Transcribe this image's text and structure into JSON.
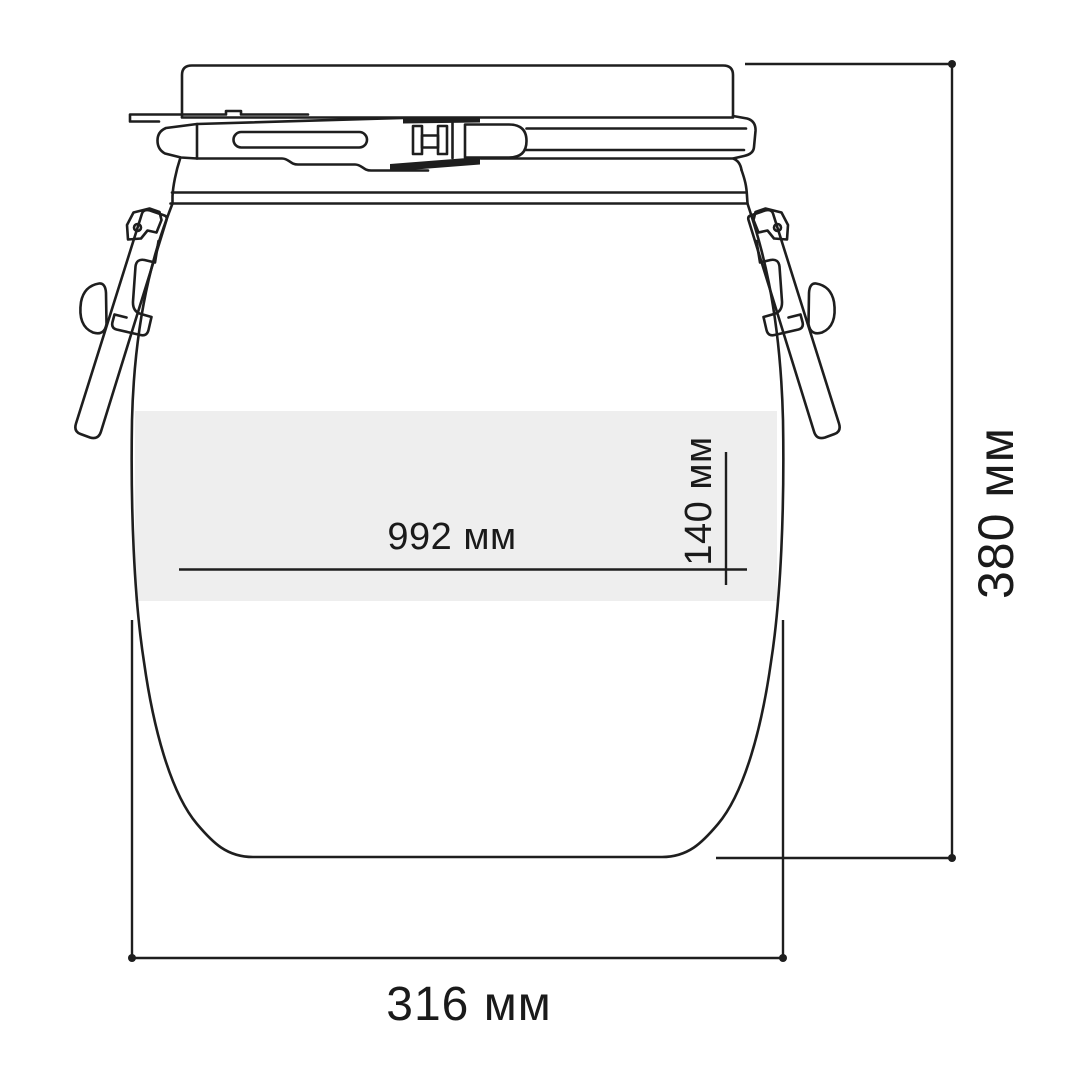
{
  "diagram": {
    "labels": {
      "inner_width": "992 мм",
      "band_height": "140 мм",
      "total_height": "380 мм",
      "total_width": "316 мм"
    },
    "colors": {
      "line": "#1e1e1e",
      "text": "#1a1a1a",
      "band": "#eeeeee",
      "background": "#ffffff"
    }
  }
}
